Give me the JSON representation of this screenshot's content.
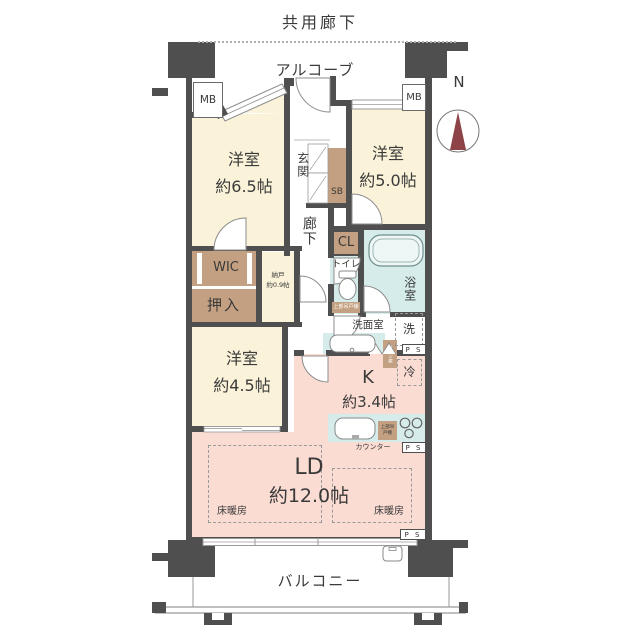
{
  "t": {
    "kyoyo_roka": "共用廊下",
    "alcove": "アルコーブ",
    "north": "N",
    "mb": "MB",
    "genkan": "玄関",
    "sb": "SB",
    "roka": "廊下",
    "cl": "CL",
    "toilet": "トイレ",
    "toilet_shelf": "上部吊戸棚",
    "bath": "浴室",
    "senmenshitsu": "洗面室",
    "washer": "洗",
    "linen": "リネン庫",
    "fridge": "冷",
    "k": "K",
    "k_size": "約3.4帖",
    "counter": "カウンター",
    "counter_shelf": "上部吊戸棚",
    "wic": "WIC",
    "oshiire": "押入",
    "nando": "納戸",
    "nando_size": "約0.9帖",
    "ld": "LD",
    "ld_size": "約12.0帖",
    "yuka": "床暖房",
    "balcony": "バルコニー",
    "ps": "P S"
  },
  "rooms": [
    {
      "name": "洋室",
      "size": "約6.5帖"
    },
    {
      "name": "洋室",
      "size": "約5.0帖"
    },
    {
      "name": "洋室",
      "size": "約4.5帖"
    }
  ],
  "colors": {
    "wall": "#4f4f4f",
    "room_cream": "#faf3d9",
    "closet_tan": "#c3a081",
    "ldk_pink": "#fadcd2",
    "wet_blue": "#d6ecea",
    "compass_red": "#8d4347",
    "text": "#3a3a3a"
  }
}
